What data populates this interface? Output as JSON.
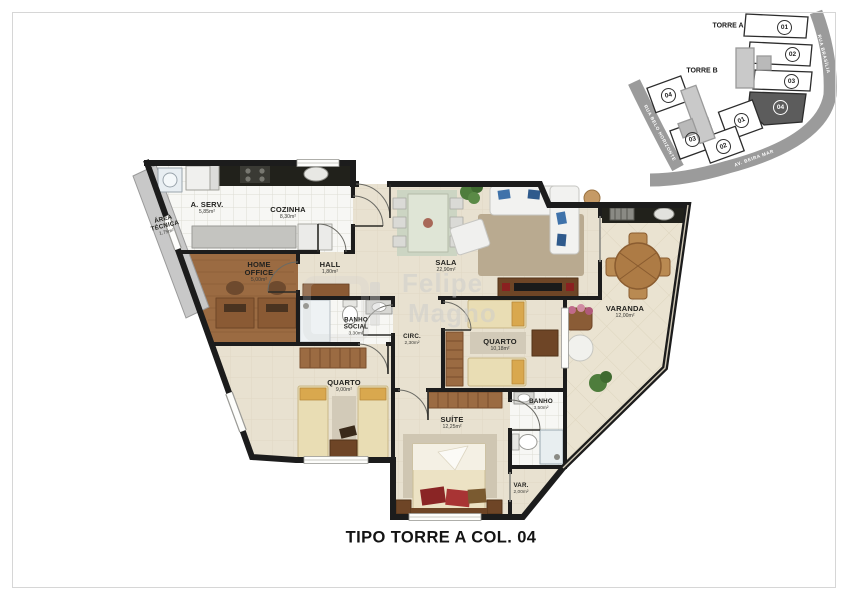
{
  "title": "TIPO TORRE A COL. 04",
  "watermark": {
    "line1": "Felipe",
    "line2": "Magno"
  },
  "rooms": [
    {
      "id": "area-servico",
      "name": "A. SERV.",
      "area": "5,85m²"
    },
    {
      "id": "cozinha",
      "name": "COZINHA",
      "area": "8,30m²"
    },
    {
      "id": "area-tecnica",
      "name": "ÁREA TÉCNICA",
      "area": "1,75m²"
    },
    {
      "id": "home-office",
      "name": "HOME OFFICE",
      "area": "5,00m²"
    },
    {
      "id": "hall",
      "name": "HALL",
      "area": "1,80m²"
    },
    {
      "id": "sala",
      "name": "SALA",
      "area": "22,90m²"
    },
    {
      "id": "varanda",
      "name": "VARANDA",
      "area": "12,00m²"
    },
    {
      "id": "banho-social",
      "name": "BANHO SOCIAL",
      "area": "3,30m²"
    },
    {
      "id": "circulacao",
      "name": "CIRC.",
      "area": "2,30m²"
    },
    {
      "id": "quarto-2",
      "name": "QUARTO",
      "area": "10,18m²"
    },
    {
      "id": "quarto-1",
      "name": "QUARTO",
      "area": "9,00m²"
    },
    {
      "id": "suite",
      "name": "SUÍTE",
      "area": "12,25m²"
    },
    {
      "id": "banho-suite",
      "name": "BANHO",
      "area": "3,50m²"
    },
    {
      "id": "var",
      "name": "VAR.",
      "area": "2,00m²"
    }
  ],
  "site_map": {
    "torre_a": {
      "label": "TORRE A",
      "units": [
        "01",
        "02",
        "03",
        "04"
      ],
      "highlighted_unit": "04"
    },
    "torre_b": {
      "label": "TORRE B",
      "units": [
        "04",
        "01",
        "03",
        "02"
      ]
    },
    "streets": [
      "RUA BRASÍLIA",
      "RUA BELO HORIZONTE",
      "AV. BEIRA MAR"
    ]
  },
  "colors": {
    "wall": "#1c1c1c",
    "floor_beige": "#e8e1d0",
    "tile_white": "#f7f7f4",
    "wood": "#9b6b42",
    "counter_dark": "#21211b",
    "street_gray": "#9b9b9b",
    "highlighted_unit_fill": "#5c5c5c",
    "sofa_pillow_blue": "#3f72aa"
  }
}
